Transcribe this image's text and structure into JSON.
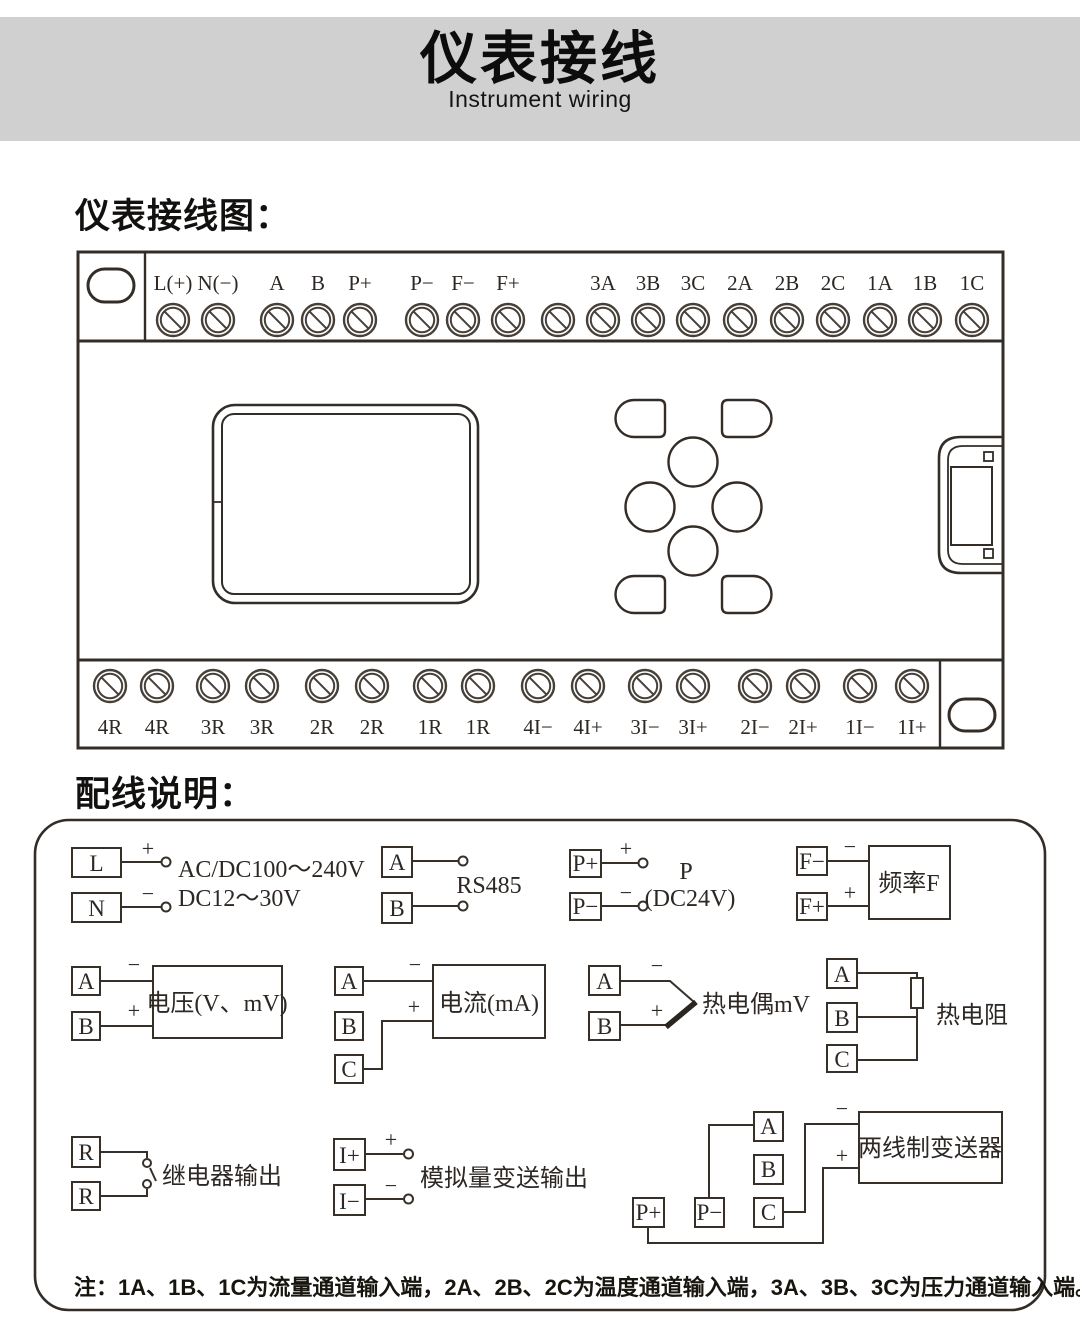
{
  "header": {
    "title": "仪表接线",
    "subtitle": "Instrument wiring"
  },
  "sections": {
    "diagram_title": "仪表接线图：",
    "wiring_title": "配线说明："
  },
  "device": {
    "top_terminals": [
      "L(+)",
      "N(−)",
      "A",
      "B",
      "P+",
      "P−",
      "F−",
      "F+",
      "",
      "3A",
      "3B",
      "3C",
      "2A",
      "2B",
      "2C",
      "1A",
      "1B",
      "1C"
    ],
    "bottom_terminals": [
      "4R",
      "4R",
      "3R",
      "3R",
      "2R",
      "2R",
      "1R",
      "1R",
      "4I−",
      "4I+",
      "3I−",
      "3I+",
      "2I−",
      "2I+",
      "1I−",
      "1I+"
    ]
  },
  "wiring": {
    "power": {
      "t1": "L",
      "t2": "N",
      "plus": "+",
      "minus": "−",
      "line1": "AC/DC100～240V",
      "line2": "DC12～30V"
    },
    "rs485": {
      "t1": "A",
      "t2": "B",
      "label": "RS485"
    },
    "p24": {
      "t1": "P+",
      "t2": "P−",
      "plus": "+",
      "minus": "−",
      "line1": "P",
      "line2": "(DC24V)"
    },
    "frequency": {
      "t1": "F−",
      "t2": "F+",
      "minus": "−",
      "plus": "+",
      "box": "频率F"
    },
    "voltage": {
      "t1": "A",
      "t2": "B",
      "minus": "−",
      "plus": "+",
      "box": "电压(V、mV)"
    },
    "current": {
      "t1": "A",
      "t2": "B",
      "t3": "C",
      "minus": "−",
      "plus": "+",
      "box": "电流(mA)"
    },
    "thermocouple": {
      "t1": "A",
      "t2": "B",
      "minus": "−",
      "plus": "+",
      "label": "热电偶mV"
    },
    "rtd": {
      "t1": "A",
      "t2": "B",
      "t3": "C",
      "label": "热电阻"
    },
    "relay": {
      "t1": "R",
      "t2": "R",
      "label": "继电器输出"
    },
    "analog_out": {
      "t1": "I+",
      "t2": "I−",
      "plus": "+",
      "minus": "−",
      "label": "模拟量变送输出"
    },
    "transmitter": {
      "a": "A",
      "b": "B",
      "c": "C",
      "pplus": "P+",
      "pminus": "P−",
      "minus": "−",
      "plus": "+",
      "box": "两线制变送器"
    }
  },
  "note": "注：1A、1B、1C为流量通道输入端，2A、2B、2C为温度通道输入端，3A、3B、3C为压力通道输入端。",
  "colors": {
    "header_band": "#d1d0d0",
    "line": "#332c27",
    "text": "#1c1917",
    "background": "#ffffff"
  }
}
